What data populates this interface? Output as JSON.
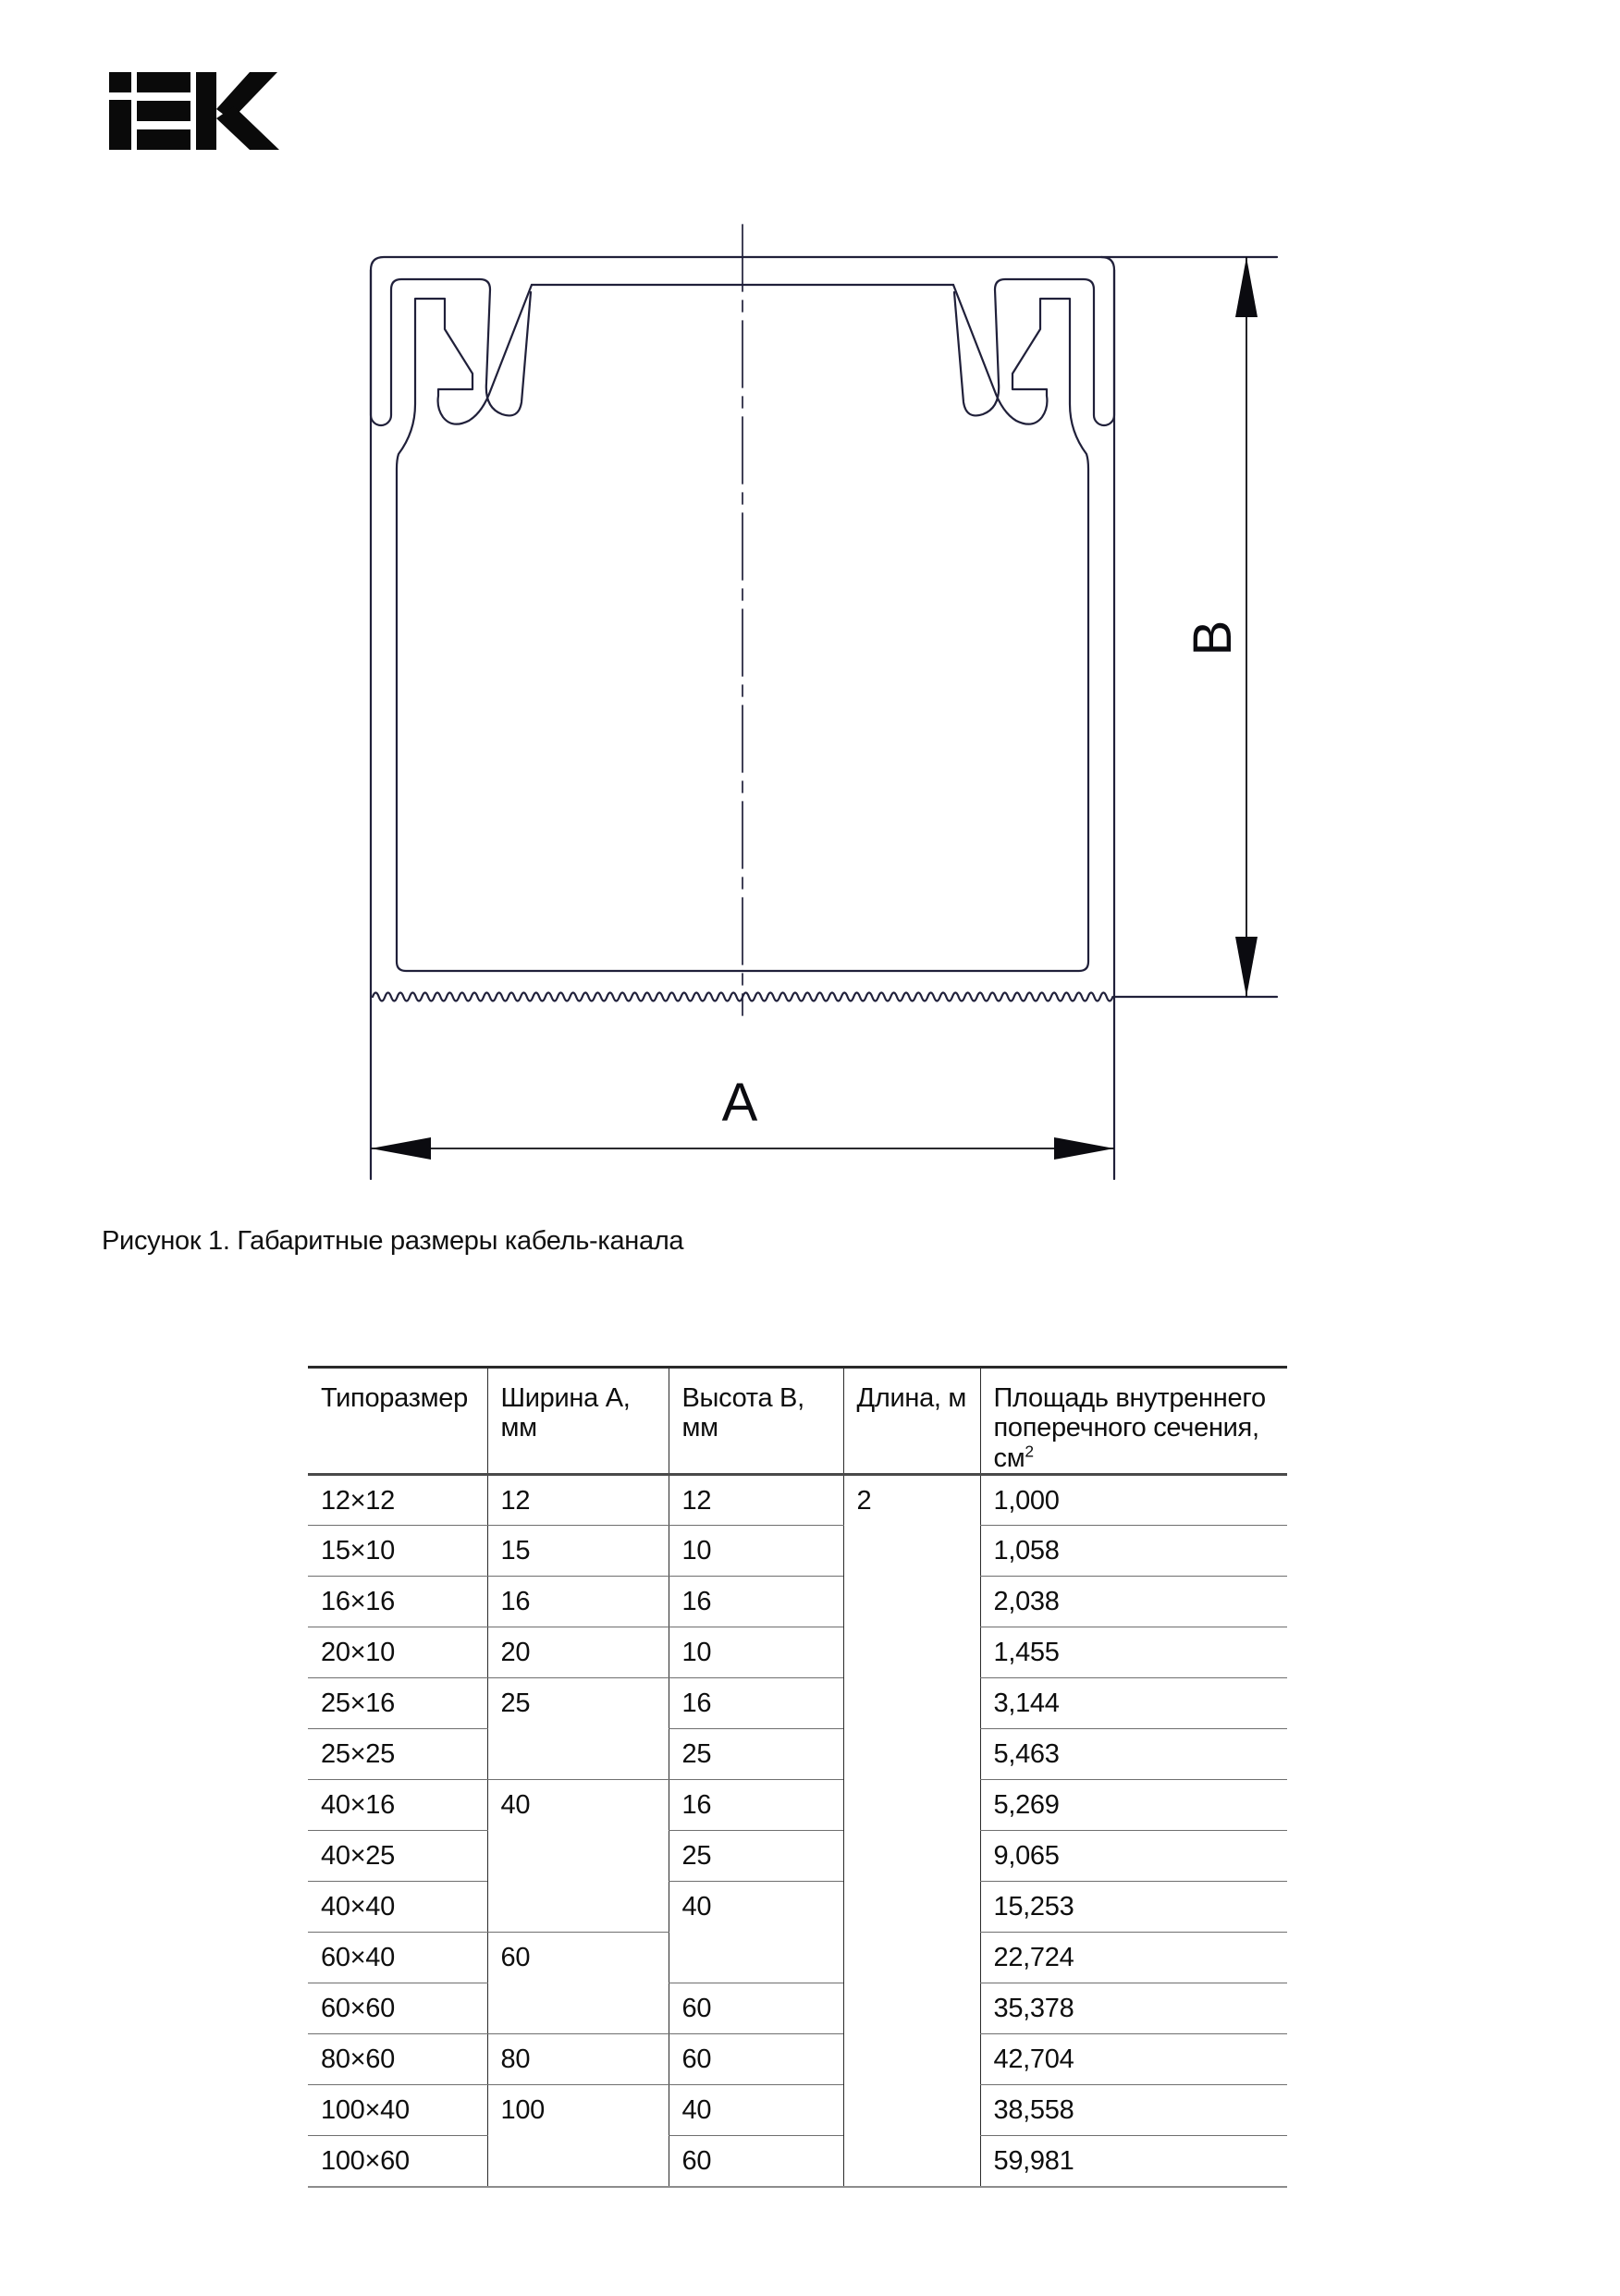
{
  "logo": {
    "name": "IEK"
  },
  "figure": {
    "caption": "Рисунок 1. Габаритные размеры кабель-канала",
    "width_label": "A",
    "height_label": "B",
    "ink_color": "#20203a",
    "dim_color": "#0b0b10"
  },
  "table": {
    "headers": [
      "Типоразмер",
      "Ширина А, мм",
      "Высота В, мм",
      "Длина, м"
    ],
    "area_header_line1": "Площадь внутреннего",
    "area_header_line2": "поперечного сечения, см",
    "area_sup": "2",
    "length_value": "2",
    "rows": [
      {
        "size": "12×12",
        "width": "12",
        "height": "12",
        "area": "1,000"
      },
      {
        "size": "15×10",
        "width": "15",
        "height": "10",
        "area": "1,058"
      },
      {
        "size": "16×16",
        "width": "16",
        "height": "16",
        "area": "2,038"
      },
      {
        "size": "20×10",
        "width": "20",
        "height": "10",
        "area": "1,455"
      },
      {
        "size": "25×16",
        "width": "25",
        "height": "16",
        "area": "3,144"
      },
      {
        "size": "25×25",
        "height": "25",
        "area": "5,463"
      },
      {
        "size": "40×16",
        "width": "40",
        "height": "16",
        "area": "5,269"
      },
      {
        "size": "40×25",
        "height": "25",
        "area": "9,065"
      },
      {
        "size": "40×40",
        "height": "40",
        "area": "15,253"
      },
      {
        "size": "60×40",
        "width": "60",
        "area": "22,724"
      },
      {
        "size": "60×60",
        "height": "60",
        "area": "35,378"
      },
      {
        "size": "80×60",
        "width": "80",
        "height": "60",
        "area": "42,704"
      },
      {
        "size": "100×40",
        "width": "100",
        "height": "40",
        "area": "38,558"
      },
      {
        "size": "100×60",
        "height": "60",
        "area": "59,981"
      }
    ]
  }
}
